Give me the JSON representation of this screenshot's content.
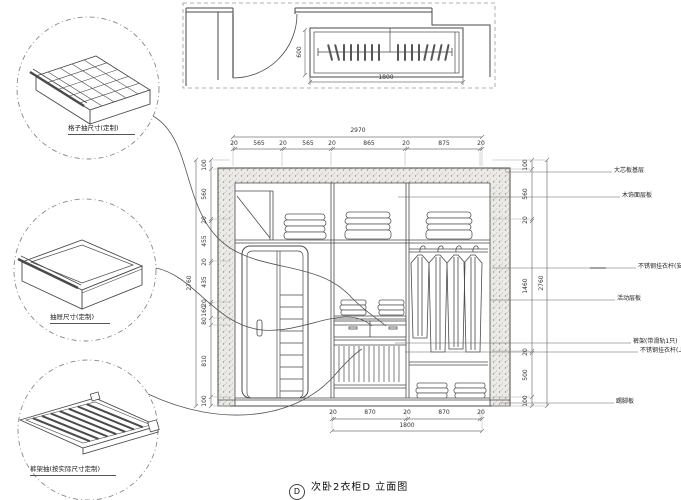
{
  "drawing": {
    "title": "次卧2衣柜D 立面图",
    "title_bubble": "D",
    "colors": {
      "line": "#4a4a4a",
      "speckle_bg": "#eceae6",
      "speckle_dot": "#8f8f8a",
      "dim_text": "#333333"
    }
  },
  "plan_view": {
    "depth_dim": "600",
    "width_dim": "1800"
  },
  "elevation": {
    "top_dims": {
      "overall": "2970",
      "segments": [
        "20",
        "565",
        "20",
        "565",
        "20",
        "865",
        "20",
        "875",
        "20"
      ]
    },
    "left_dims": {
      "overall": "2760",
      "segments": [
        "100",
        "560",
        "20",
        "455",
        "20",
        "435",
        "20",
        "160",
        "80",
        "810",
        "100"
      ]
    },
    "right_dims": {
      "overall": "2760",
      "segments": [
        "100",
        "560",
        "20",
        "1460",
        "20",
        "500",
        "100"
      ]
    },
    "bottom_dims": {
      "overall": "1800",
      "segments": [
        "20",
        "870",
        "20",
        "870",
        "20"
      ]
    }
  },
  "annotations": [
    {
      "label": "大芯板基层"
    },
    {
      "label": "木饰面层板"
    },
    {
      "label": "不锈钢挂衣杆(安装2只)"
    },
    {
      "label": "活动层板"
    },
    {
      "label": "裤架(带滑轨1只)"
    },
    {
      "label": "不锈钢挂衣杆(上1只)"
    },
    {
      "label": "踢脚板"
    }
  ],
  "details": [
    {
      "label": "格子抽尺寸(定制)"
    },
    {
      "label": "抽屉尺寸(定制)"
    },
    {
      "label": "裤架抽(按实际尺寸定制)"
    }
  ]
}
